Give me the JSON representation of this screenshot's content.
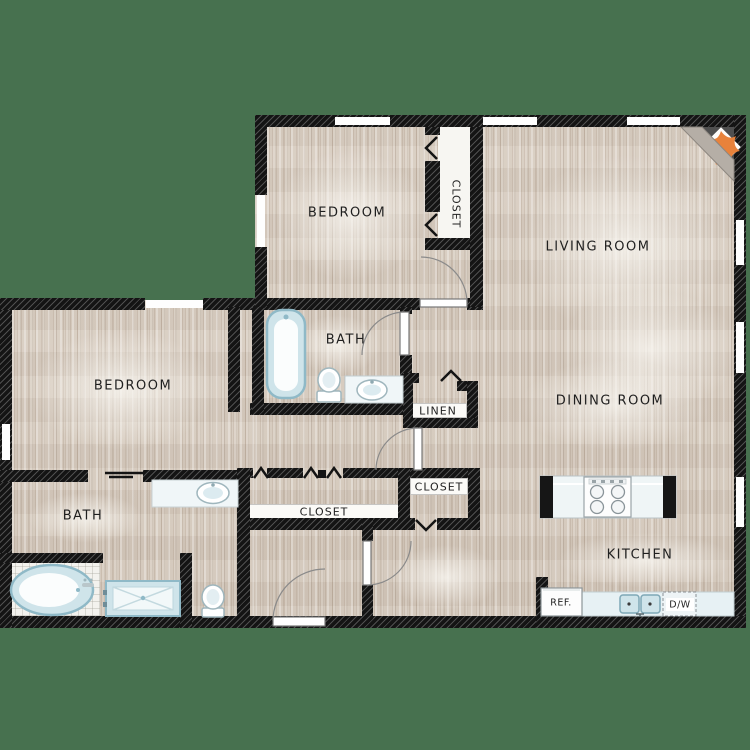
{
  "title": "Two bedroom two bath apartment floor plan",
  "labels": {
    "bedroom_top": "BEDROOM",
    "closet_top": "CLOSET",
    "living_room": "LIVING ROOM",
    "bath_middle": "BATH",
    "linen": "LINEN",
    "bedroom_left": "BEDROOM",
    "bath_left": "BATH",
    "closet_hall": "CLOSET",
    "closet_small": "CLOSET",
    "dining_room": "DINING ROOM",
    "kitchen": "KITCHEN",
    "refrigerator": "REF.",
    "dishwasher": "D/W"
  },
  "colors": {
    "background": "#47714f",
    "walls": "#141414",
    "wood_floor": "#d7ccc0",
    "closet_floor": "#f7f6f2",
    "fixtures_blue": "#cfe4ea",
    "flame_accent": "#e8823b"
  }
}
